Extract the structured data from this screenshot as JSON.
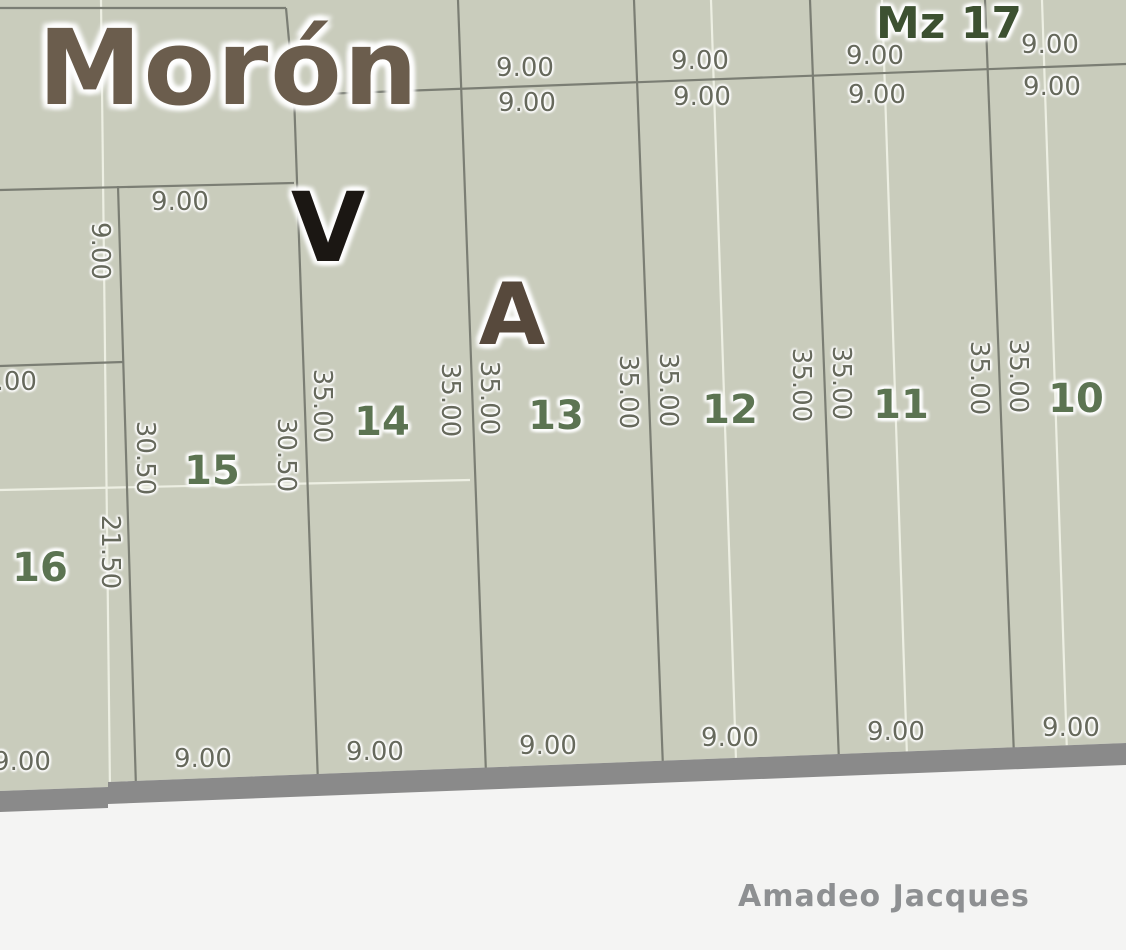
{
  "map": {
    "city_label": "Morón",
    "block_label": "Mz 17",
    "bottom_street_label": "Amadeo Jacques",
    "street_name_letters": [
      {
        "text": "V",
        "x": 328,
        "y": 228,
        "size": 96,
        "color": "#1b1713"
      },
      {
        "text": "A",
        "x": 512,
        "y": 315,
        "size": 86,
        "color": "#57493c"
      }
    ],
    "lot_numbers": [
      {
        "text": "16",
        "x": 40,
        "y": 568
      },
      {
        "text": "15",
        "x": 212,
        "y": 471
      },
      {
        "text": "14",
        "x": 382,
        "y": 422
      },
      {
        "text": "13",
        "x": 556,
        "y": 416
      },
      {
        "text": "12",
        "x": 730,
        "y": 410
      },
      {
        "text": "11",
        "x": 901,
        "y": 405
      },
      {
        "text": "10",
        "x": 1076,
        "y": 399
      }
    ],
    "dimension_labels": [
      {
        "text": "9.00",
        "x": 525,
        "y": 68,
        "rot": false
      },
      {
        "text": "9.00",
        "x": 700,
        "y": 61,
        "rot": false
      },
      {
        "text": "9.00",
        "x": 875,
        "y": 56,
        "rot": false
      },
      {
        "text": "9.00",
        "x": 1050,
        "y": 45,
        "rot": false
      },
      {
        "text": "9.00",
        "x": 527,
        "y": 103,
        "rot": false
      },
      {
        "text": "9.00",
        "x": 702,
        "y": 97,
        "rot": false
      },
      {
        "text": "9.00",
        "x": 877,
        "y": 95,
        "rot": false
      },
      {
        "text": "9.00",
        "x": 1052,
        "y": 87,
        "rot": false
      },
      {
        "text": "9.00",
        "x": 180,
        "y": 202,
        "rot": false
      },
      {
        "text": "9.00",
        "x": 100,
        "y": 251,
        "rot": true
      },
      {
        "text": "9.00",
        "x": 8,
        "y": 382,
        "rot": false
      },
      {
        "text": "30.50",
        "x": 145,
        "y": 458,
        "rot": true
      },
      {
        "text": "30.50",
        "x": 286,
        "y": 455,
        "rot": true
      },
      {
        "text": "21.50",
        "x": 110,
        "y": 552,
        "rot": true
      },
      {
        "text": "35.00",
        "x": 322,
        "y": 406,
        "rot": true
      },
      {
        "text": "35.00",
        "x": 450,
        "y": 400,
        "rot": true
      },
      {
        "text": "35.00",
        "x": 489,
        "y": 398,
        "rot": true
      },
      {
        "text": "35.00",
        "x": 628,
        "y": 392,
        "rot": true
      },
      {
        "text": "35.00",
        "x": 668,
        "y": 390,
        "rot": true
      },
      {
        "text": "35.00",
        "x": 801,
        "y": 385,
        "rot": true
      },
      {
        "text": "35.00",
        "x": 841,
        "y": 383,
        "rot": true
      },
      {
        "text": "35.00",
        "x": 979,
        "y": 378,
        "rot": true
      },
      {
        "text": "35.00",
        "x": 1018,
        "y": 376,
        "rot": true
      },
      {
        "text": "9.00",
        "x": 22,
        "y": 762,
        "rot": false
      },
      {
        "text": "9.00",
        "x": 203,
        "y": 759,
        "rot": false
      },
      {
        "text": "9.00",
        "x": 375,
        "y": 752,
        "rot": false
      },
      {
        "text": "9.00",
        "x": 548,
        "y": 746,
        "rot": false
      },
      {
        "text": "9.00",
        "x": 730,
        "y": 738,
        "rot": false
      },
      {
        "text": "9.00",
        "x": 896,
        "y": 732,
        "rot": false
      },
      {
        "text": "9.00",
        "x": 1071,
        "y": 728,
        "rot": false
      }
    ],
    "colors": {
      "parcel_fill": "#c9ccbc",
      "street_fill": "#f4f4f3",
      "street_band": "#8a8a8a",
      "parcel_line": "#7b7e74",
      "light_line": "#edefe3",
      "dimension_text": "#66695c",
      "lot_number_text": "#5c7452",
      "block_label_text": "#3d5131",
      "city_label_text": "#6b5d4d",
      "street_label_text": "#8e9092"
    }
  }
}
